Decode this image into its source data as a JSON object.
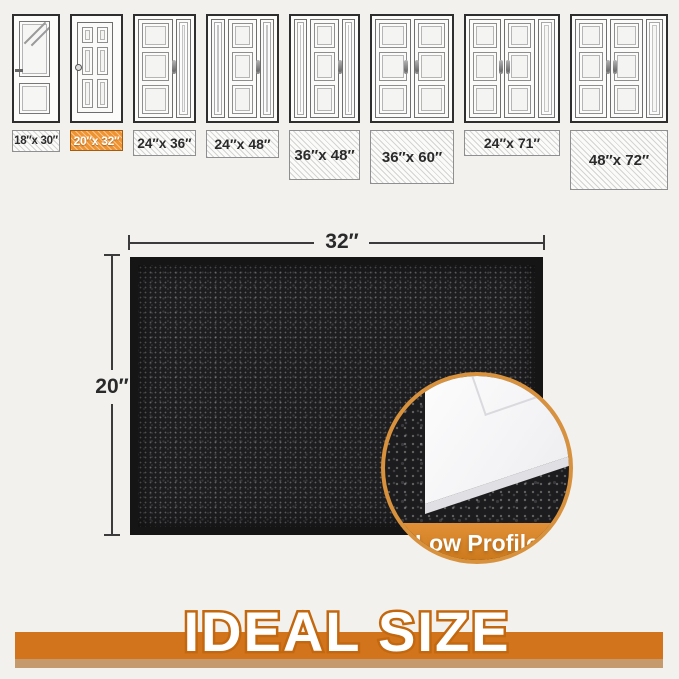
{
  "size_guide": {
    "doors": [
      {
        "label": "18″x 30″",
        "type": "glass-panel",
        "highlighted": false
      },
      {
        "label": "20″x 32″",
        "type": "six-panel",
        "highlighted": true
      },
      {
        "label": "24″x 36″",
        "type": "leaf-side",
        "highlighted": false
      },
      {
        "label": "24″x 48″",
        "type": "side-leaf-side",
        "highlighted": false
      },
      {
        "label": "36″x 48″",
        "type": "side-leaf-side",
        "highlighted": false
      },
      {
        "label": "36″x 60″",
        "type": "double",
        "highlighted": false
      },
      {
        "label": "24″x 71″",
        "type": "double-side",
        "highlighted": false
      },
      {
        "label": "48″x 72″",
        "type": "double-side",
        "highlighted": false
      }
    ],
    "highlight_color": "#ef9331"
  },
  "mat": {
    "width_label": "32″",
    "depth_label": "20″",
    "surface_color": "#1e1e20"
  },
  "inset": {
    "caption": "Low Profile",
    "accent_color": "#d8913c"
  },
  "banner": {
    "title": "IDEAL SIZE",
    "bar_color": "#d2741c"
  }
}
